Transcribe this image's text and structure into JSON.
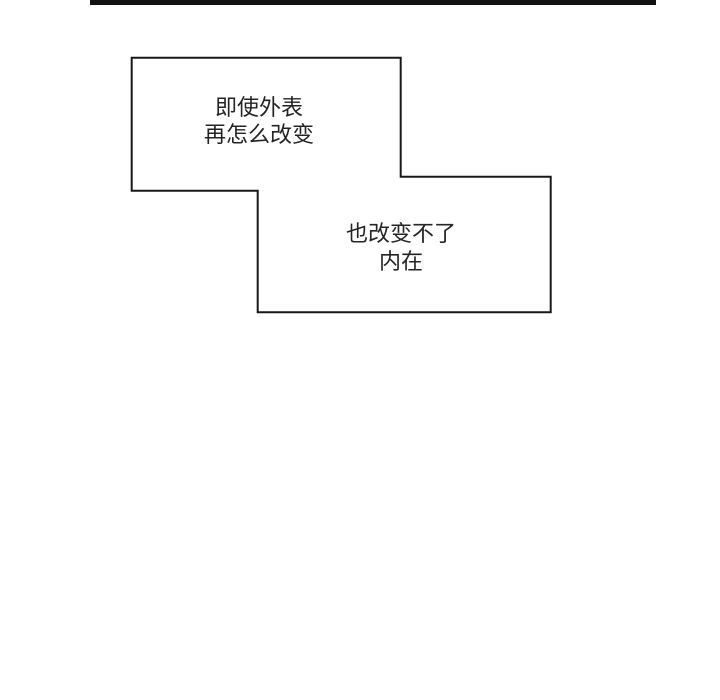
{
  "page": {
    "type": "comic-panel",
    "background_color": "#ffffff"
  },
  "panel_divider": {
    "color": "#111111"
  },
  "bubbles": [
    {
      "name": "caption-box-1",
      "lines": [
        "即使外表",
        "再怎么改变"
      ]
    },
    {
      "name": "caption-box-2",
      "lines": [
        "也改变不了",
        "内在"
      ]
    }
  ],
  "colors": {
    "bubble_border": "#181818",
    "bubble_fill": "#ffffff",
    "text": "#242424",
    "divider": "#111111"
  }
}
